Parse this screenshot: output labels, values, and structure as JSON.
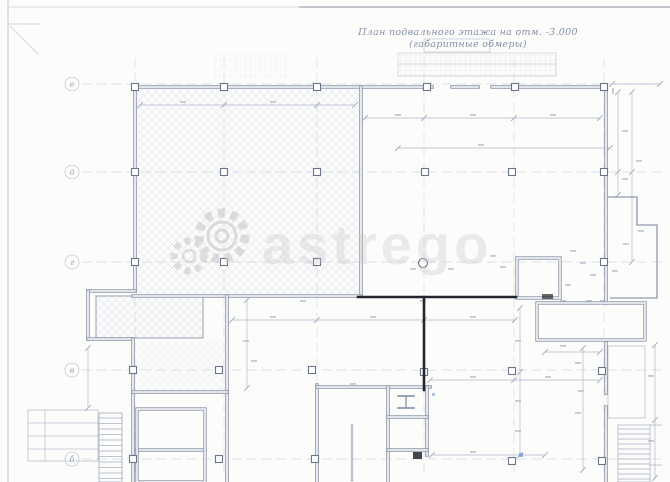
{
  "title": {
    "line1": "План подвального этажа на отм. -3.000",
    "line2": "(габаритные обмеры)"
  },
  "watermark": {
    "text": "astrego"
  },
  "grid": {
    "rows": [
      {
        "label": "е"
      },
      {
        "label": "д"
      },
      {
        "label": "г"
      },
      {
        "label": "в"
      },
      {
        "label": "б"
      }
    ]
  },
  "colors": {
    "wall": "#8f99ad",
    "wall_inner": "#fcfcfb",
    "bold": "#23262e",
    "dim": "#a9b1c3",
    "grid_dash": "#c3cad9",
    "hatch": "#d3d8e4",
    "mesh": "#ccd3e0",
    "frame": "#c2c6cd",
    "speck": "#b9c0cf",
    "blue_mark": "#7a9fd4",
    "watermark": "#c7c7c7"
  }
}
